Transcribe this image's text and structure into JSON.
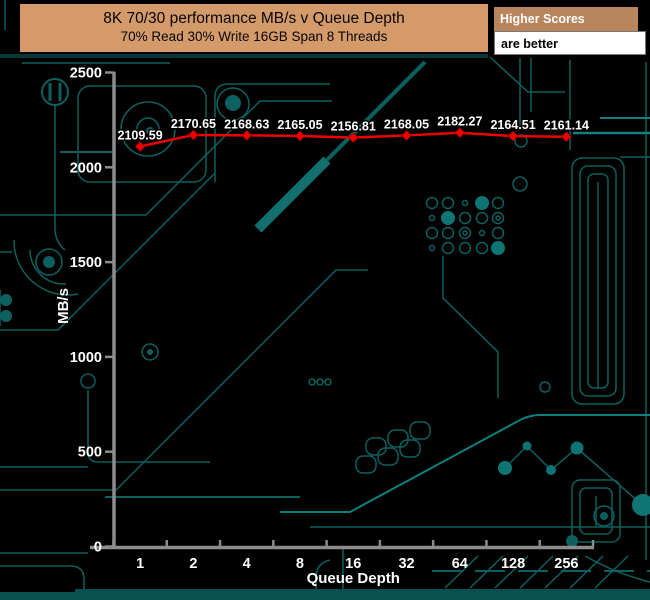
{
  "chart_data": {
    "type": "line",
    "title": "8K 70/30 performance MB/s v Queue Depth",
    "subtitle": "70% Read 30% Write 16GB Span 8 Threads",
    "xlabel": "Queue Depth",
    "ylabel": "MB/s",
    "categories": [
      "1",
      "2",
      "4",
      "8",
      "16",
      "32",
      "64",
      "128",
      "256"
    ],
    "values": [
      2109.59,
      2170.65,
      2168.63,
      2165.05,
      2156.81,
      2168.05,
      2182.27,
      2164.51,
      2161.14
    ],
    "point_labels": [
      "2109.59",
      "2170.65",
      "2168.63",
      "2165.05",
      "2156.81",
      "2168.05",
      "2182.27",
      "2164.51",
      "2161.14"
    ],
    "ylim": [
      0,
      2500
    ],
    "yticks": [
      0,
      500,
      1000,
      1500,
      2000,
      2500
    ],
    "grid": false,
    "legend_position": "none"
  },
  "badge": {
    "line1": "Higher Scores",
    "line2": "are better"
  },
  "colors": {
    "title_bg": "#d49a6a",
    "badge_bg": "#b9855c",
    "line": "#ee0000",
    "marker": "#ee0000",
    "label_text": "#ffffff",
    "axis": "#8c8c8c",
    "circuit": "#0d6060",
    "circuit_bright": "#0f8080",
    "background": "#000000"
  }
}
